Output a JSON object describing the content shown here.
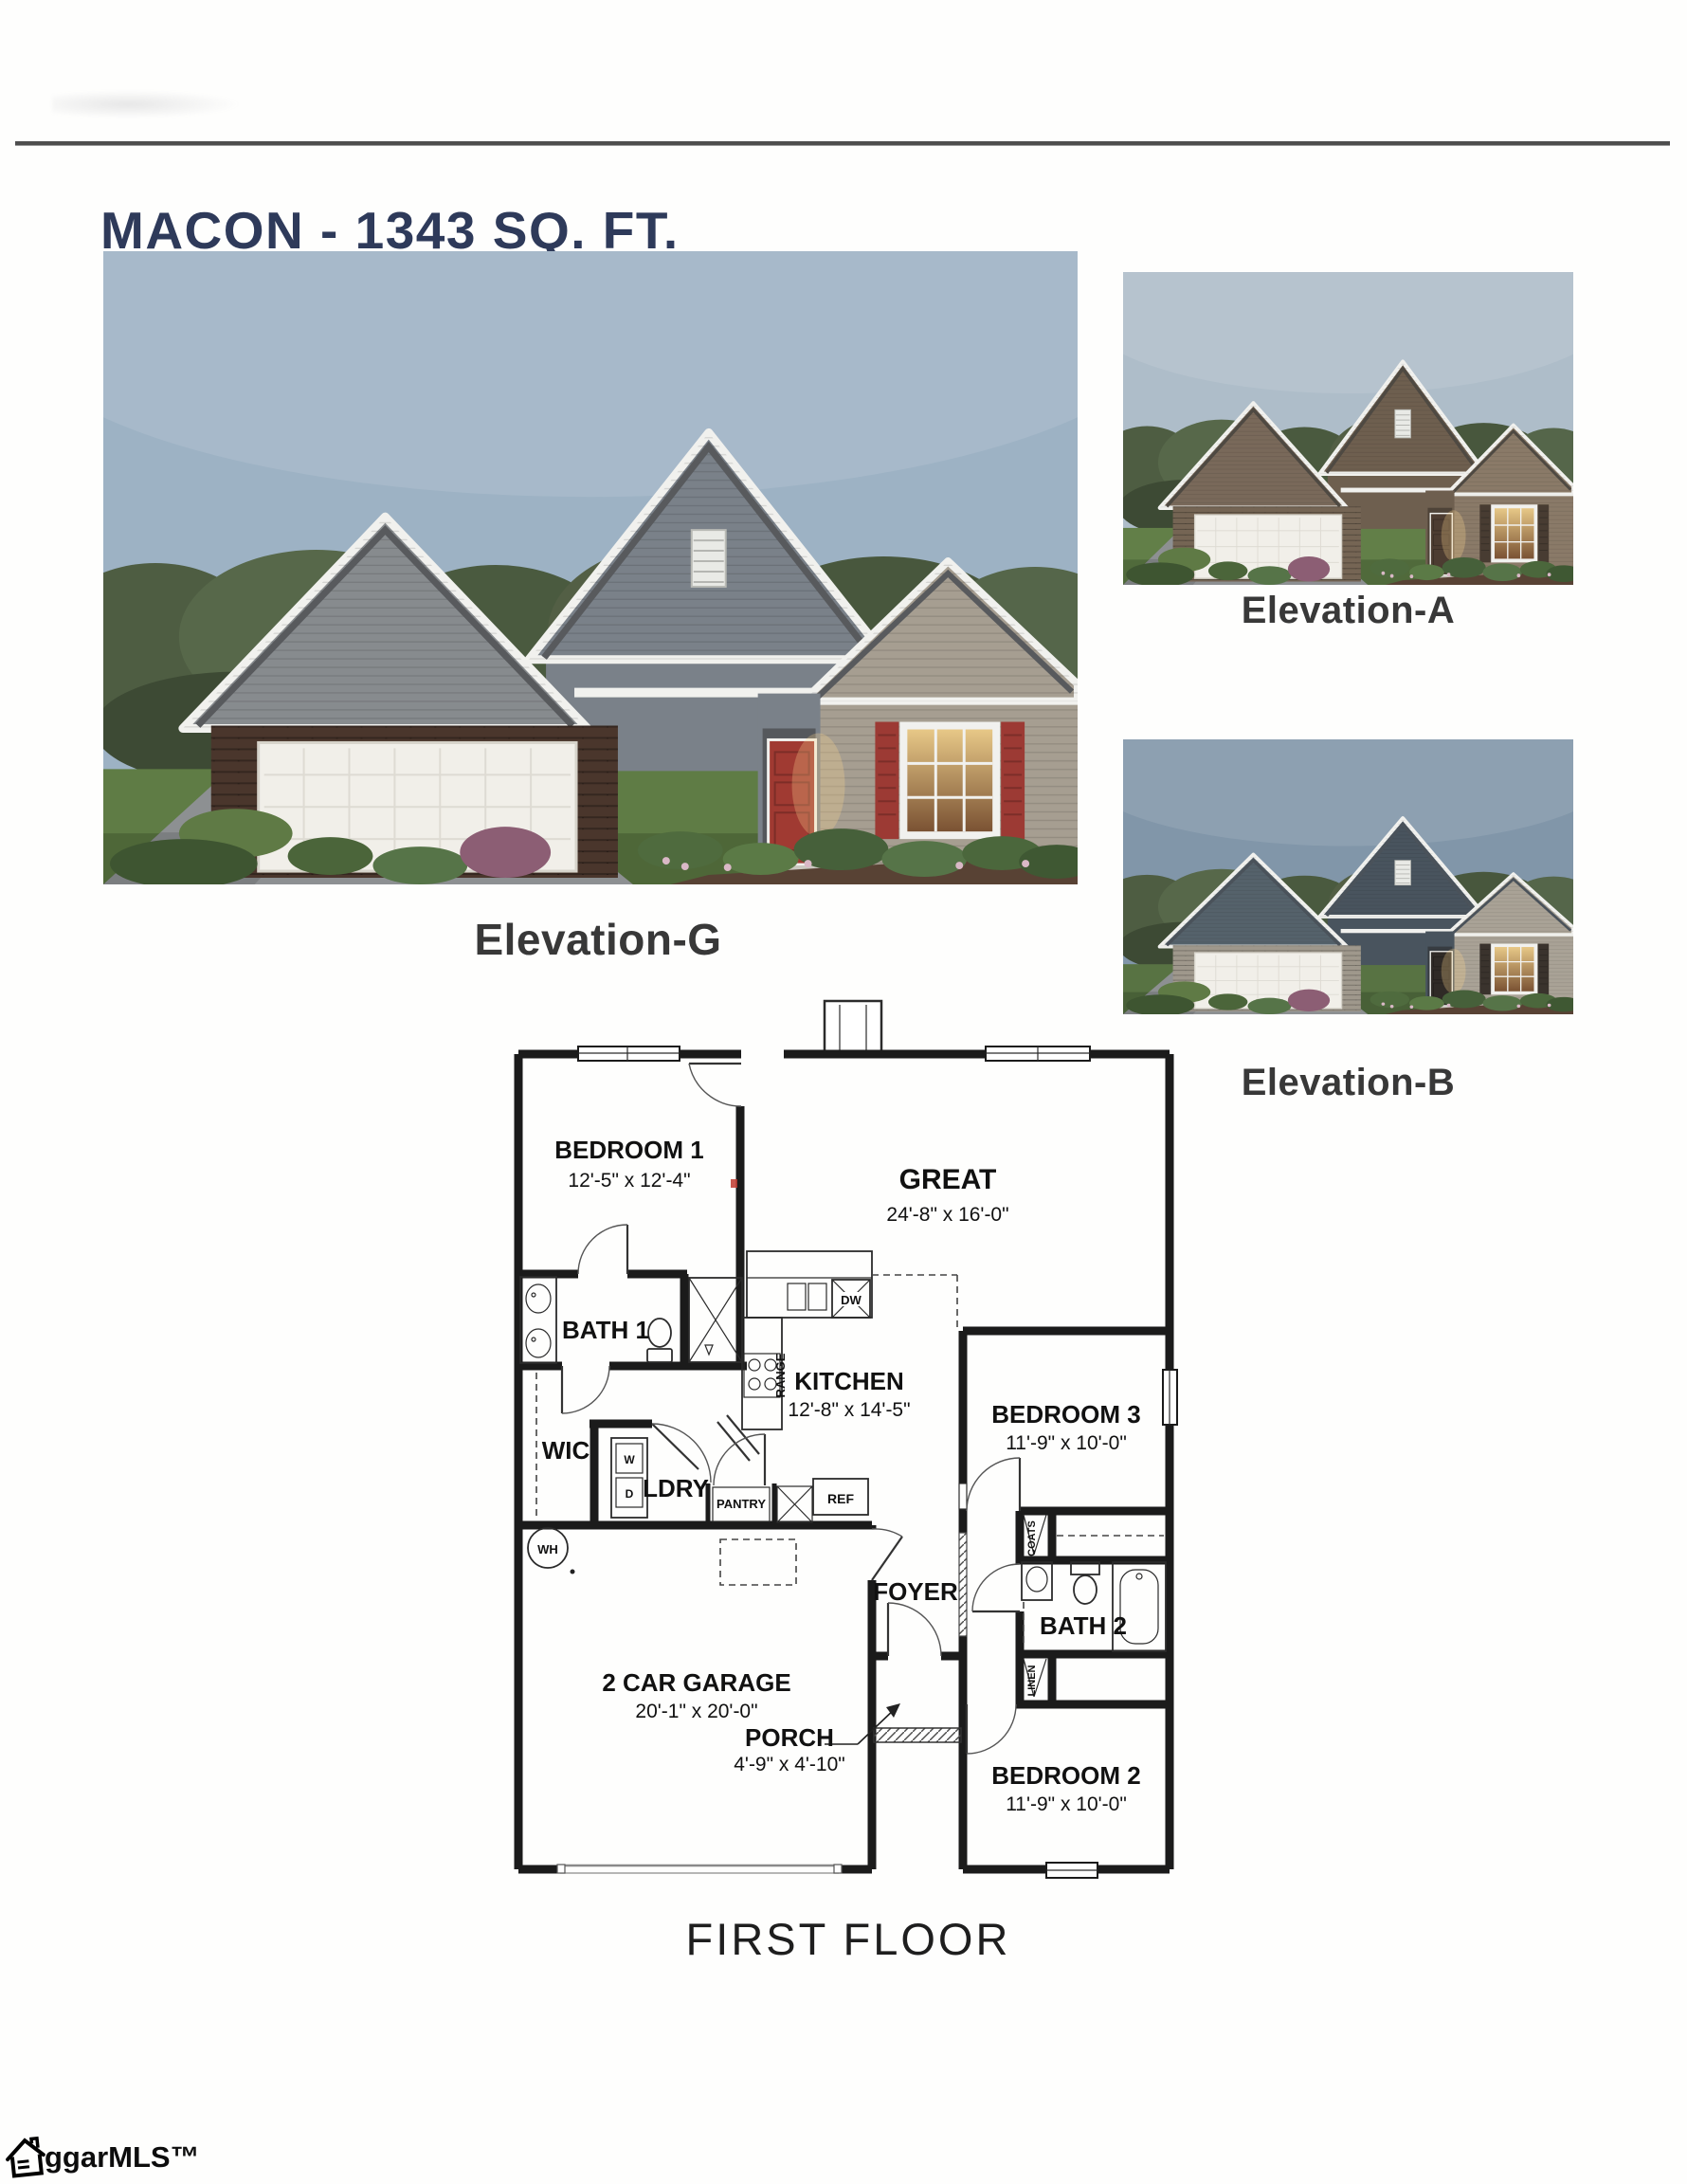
{
  "header": {
    "title": "MACON - 1343 SQ. FT."
  },
  "elevations": {
    "g_label": "Elevation-G",
    "a_label": "Elevation-A",
    "b_label": "Elevation-B"
  },
  "plan": {
    "floor_label": "FIRST FLOOR",
    "bedroom1": {
      "name": "BEDROOM 1",
      "dims": "12'-5\" x 12'-4\""
    },
    "great": {
      "name": "GREAT",
      "dims": "24'-8\" x 16'-0\""
    },
    "bath1": {
      "name": "BATH 1"
    },
    "wic": {
      "name": "WIC"
    },
    "ldry": {
      "name": "LDRY"
    },
    "washer": {
      "name": "W"
    },
    "dryer": {
      "name": "D"
    },
    "pantry": {
      "name": "PANTRY"
    },
    "ref": {
      "name": "REF"
    },
    "range": {
      "name": "RANGE"
    },
    "dw": {
      "name": "DW"
    },
    "wh": {
      "name": "WH"
    },
    "kitchen": {
      "name": "KITCHEN",
      "dims": "12'-8\" x 14'-5\""
    },
    "foyer": {
      "name": "FOYER"
    },
    "coats": {
      "name": "COATS"
    },
    "linen": {
      "name": "LINEN"
    },
    "bath2": {
      "name": "BATH 2"
    },
    "bedroom3": {
      "name": "BEDROOM 3",
      "dims": "11'-9\" x 10'-0\""
    },
    "bedroom2": {
      "name": "BEDROOM 2",
      "dims": "11'-9\" x 10'-0\""
    },
    "garage": {
      "name": "2 CAR GARAGE",
      "dims": "20'-1\" x 20'-0\""
    },
    "porch": {
      "name": "PORCH",
      "dims": "4'-9\" x 4'-10\""
    }
  },
  "footer": {
    "watermark": "ggarMLS™"
  },
  "colors": {
    "title_navy": "#2e3a5a",
    "caption_gray": "#383838",
    "wall_black": "#1b1b1b",
    "shutter_red": "#9c3a34",
    "brick_brown": "#4a362c"
  }
}
